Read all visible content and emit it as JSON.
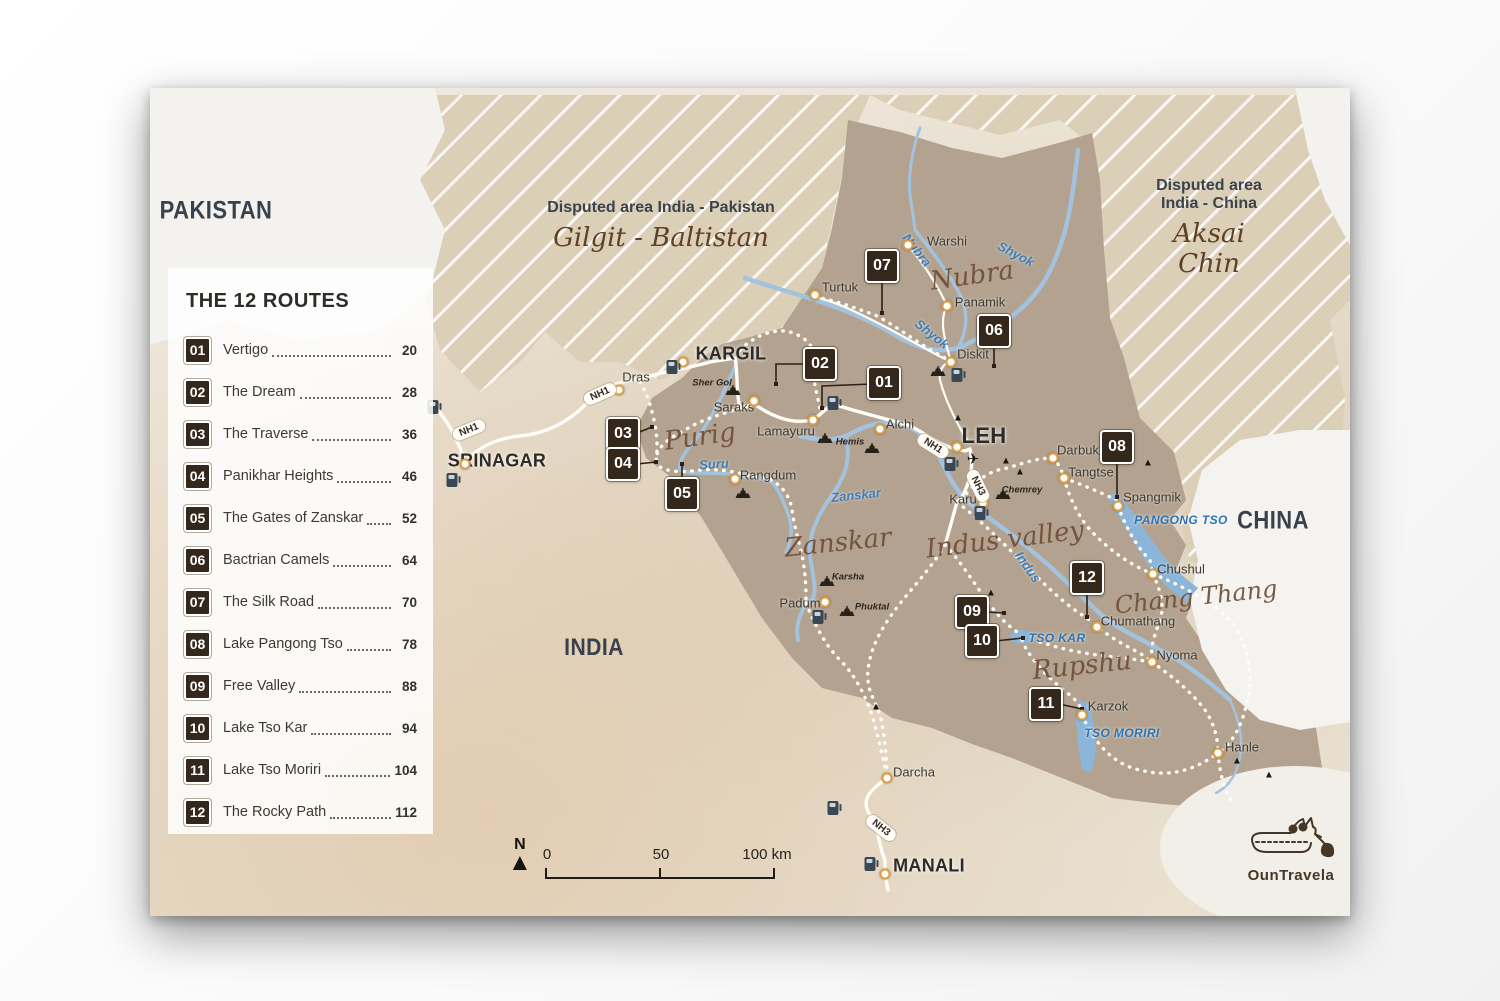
{
  "legend": {
    "title": "THE 12 ROUTES",
    "routes": [
      {
        "num": "01",
        "name": "Vertigo",
        "page": "20"
      },
      {
        "num": "02",
        "name": "The Dream",
        "page": "28"
      },
      {
        "num": "03",
        "name": "The Traverse",
        "page": "36"
      },
      {
        "num": "04",
        "name": "Panikhar Heights",
        "page": "46"
      },
      {
        "num": "05",
        "name": "The Gates of Zanskar",
        "page": "52"
      },
      {
        "num": "06",
        "name": "Bactrian Camels",
        "page": "64"
      },
      {
        "num": "07",
        "name": "The Silk Road",
        "page": "70"
      },
      {
        "num": "08",
        "name": "Lake Pangong Tso",
        "page": "78"
      },
      {
        "num": "09",
        "name": "Free Valley",
        "page": "88"
      },
      {
        "num": "10",
        "name": "Lake Tso Kar",
        "page": "94"
      },
      {
        "num": "11",
        "name": "Lake Tso Moriri",
        "page": "104"
      },
      {
        "num": "12",
        "name": "The Rocky Path",
        "page": "112"
      }
    ]
  },
  "disputed": [
    {
      "title": "Disputed area India - Pakistan",
      "subtitle": "Gilgit - Baltistan"
    },
    {
      "title": "Disputed area India - China",
      "subtitle": "Aksai Chin"
    }
  ],
  "countries": [
    {
      "t": "PAKISTAN",
      "x": 216,
      "y": 211,
      "s": 25
    },
    {
      "t": "INDIA",
      "x": 594,
      "y": 648,
      "s": 24
    },
    {
      "t": "CHINA",
      "x": 1273,
      "y": 521,
      "s": 25
    }
  ],
  "cities": [
    {
      "t": "SRINAGAR",
      "x": 497,
      "y": 461,
      "s": 18,
      "dot": [
        465,
        464
      ]
    },
    {
      "t": "KARGIL",
      "x": 731,
      "y": 354,
      "s": 18,
      "dot": [
        683,
        362
      ]
    },
    {
      "t": "LEH",
      "x": 984,
      "y": 436,
      "s": 22,
      "dot": [
        957,
        447
      ]
    },
    {
      "t": "MANALI",
      "x": 929,
      "y": 866,
      "s": 18,
      "dot": [
        885,
        874
      ]
    }
  ],
  "towns": [
    {
      "t": "Dras",
      "x": 636,
      "y": 377,
      "dot": [
        619,
        390
      ]
    },
    {
      "t": "Saraks",
      "x": 734,
      "y": 407,
      "dot": [
        754,
        401
      ]
    },
    {
      "t": "Lamayuru",
      "x": 786,
      "y": 431,
      "dot": [
        813,
        420
      ]
    },
    {
      "t": "Alchi",
      "x": 900,
      "y": 424,
      "dot": [
        880,
        429
      ]
    },
    {
      "t": "Rangdum",
      "x": 768,
      "y": 475,
      "dot": [
        735,
        479
      ]
    },
    {
      "t": "Padum",
      "x": 800,
      "y": 603,
      "dot": [
        825,
        602
      ]
    },
    {
      "t": "Turtuk",
      "x": 840,
      "y": 287,
      "dot": [
        815,
        295
      ]
    },
    {
      "t": "Warshi",
      "x": 947,
      "y": 241,
      "dot": [
        908,
        245
      ]
    },
    {
      "t": "Panamik",
      "x": 980,
      "y": 302,
      "dot": [
        947,
        306
      ]
    },
    {
      "t": "Diskit",
      "x": 973,
      "y": 354,
      "dot": [
        951,
        362
      ]
    },
    {
      "t": "Darbuk",
      "x": 1078,
      "y": 450,
      "dot": [
        1053,
        458
      ]
    },
    {
      "t": "Tangtse",
      "x": 1091,
      "y": 472,
      "dot": [
        1064,
        478
      ]
    },
    {
      "t": "Spangmik",
      "x": 1152,
      "y": 497,
      "dot": [
        1118,
        506
      ]
    },
    {
      "t": "Chushul",
      "x": 1181,
      "y": 569,
      "dot": [
        1153,
        574
      ]
    },
    {
      "t": "Chumathang",
      "x": 1138,
      "y": 621,
      "dot": [
        1097,
        627
      ]
    },
    {
      "t": "Nyoma",
      "x": 1177,
      "y": 655,
      "dot": [
        1152,
        662
      ]
    },
    {
      "t": "Karzok",
      "x": 1108,
      "y": 706,
      "dot": [
        1082,
        715
      ]
    },
    {
      "t": "Hanle",
      "x": 1242,
      "y": 747,
      "dot": [
        1218,
        753
      ]
    },
    {
      "t": "Darcha",
      "x": 914,
      "y": 772,
      "dot": [
        887,
        778
      ]
    },
    {
      "t": "Karu",
      "x": 963,
      "y": 499,
      "dot": [
        983,
        503
      ]
    }
  ],
  "monasteries": [
    {
      "t": "Sher Gol",
      "x": 712,
      "y": 383,
      "icon": [
        733,
        390
      ]
    },
    {
      "t": "Hemis",
      "x": 850,
      "y": 442,
      "icon": [
        872,
        448
      ]
    },
    {
      "t": "Karsha",
      "x": 848,
      "y": 577,
      "icon": [
        827,
        581
      ]
    },
    {
      "t": "Phuktal",
      "x": 872,
      "y": 607,
      "icon": [
        847,
        611
      ]
    },
    {
      "t": "Chemrey",
      "x": 1022,
      "y": 490,
      "icon": [
        1003,
        494
      ]
    },
    {
      "t": "",
      "x": 0,
      "y": 0,
      "icon": [
        938,
        371
      ]
    },
    {
      "t": "",
      "x": 0,
      "y": 0,
      "icon": [
        825,
        438
      ]
    },
    {
      "t": "",
      "x": 0,
      "y": 0,
      "icon": [
        743,
        493
      ]
    }
  ],
  "rivers": [
    {
      "t": "Nubra",
      "x": 917,
      "y": 250,
      "r": 52
    },
    {
      "t": "Shyok",
      "x": 1016,
      "y": 254,
      "r": 28
    },
    {
      "t": "Shyok",
      "x": 932,
      "y": 334,
      "r": 38
    },
    {
      "t": "Suru",
      "x": 714,
      "y": 464,
      "r": -4
    },
    {
      "t": "Zanskar",
      "x": 856,
      "y": 495,
      "r": -6
    },
    {
      "t": "Indus",
      "x": 1028,
      "y": 567,
      "r": 55
    }
  ],
  "lakes": [
    {
      "t": "PANGONG TSO",
      "x": 1181,
      "y": 520,
      "r": 0
    },
    {
      "t": "TSO KAR",
      "x": 1057,
      "y": 638,
      "r": 0
    },
    {
      "t": "TSO MORIRI",
      "x": 1122,
      "y": 733,
      "r": 0
    }
  ],
  "regions": [
    {
      "t": "Nubra",
      "x": 972,
      "y": 276,
      "s": 26,
      "r": -8
    },
    {
      "t": "Purig",
      "x": 700,
      "y": 437,
      "s": 26,
      "r": -8
    },
    {
      "t": "Zanskar",
      "x": 838,
      "y": 543,
      "s": 26,
      "r": -6
    },
    {
      "t": "Indus valley",
      "x": 1005,
      "y": 540,
      "s": 26,
      "r": -7
    },
    {
      "t": "Chang Thang",
      "x": 1196,
      "y": 597,
      "s": 24,
      "r": -6
    },
    {
      "t": "Rupshu",
      "x": 1082,
      "y": 666,
      "s": 26,
      "r": -6
    }
  ],
  "nh_labels": [
    {
      "t": "NH1",
      "x": 469,
      "y": 430,
      "r": -22
    },
    {
      "t": "NH1",
      "x": 600,
      "y": 394,
      "r": -24
    },
    {
      "t": "NH1",
      "x": 933,
      "y": 446,
      "r": 32
    },
    {
      "t": "NH3",
      "x": 978,
      "y": 486,
      "r": 64
    },
    {
      "t": "NH3",
      "x": 881,
      "y": 828,
      "r": 38
    }
  ],
  "markers": [
    {
      "num": "01",
      "x": 884,
      "y": 383,
      "leader": [
        [
          872,
          384
        ],
        [
          822,
          386
        ],
        [
          822,
          408
        ]
      ]
    },
    {
      "num": "02",
      "x": 820,
      "y": 364,
      "leader": [
        [
          808,
          364
        ],
        [
          776,
          364
        ],
        [
          776,
          384
        ]
      ]
    },
    {
      "num": "03",
      "x": 623,
      "y": 434,
      "leader": [
        [
          637,
          433
        ],
        [
          652,
          427
        ]
      ]
    },
    {
      "num": "04",
      "x": 623,
      "y": 464,
      "leader": [
        [
          637,
          464
        ],
        [
          656,
          462
        ]
      ]
    },
    {
      "num": "05",
      "x": 682,
      "y": 494,
      "leader": [
        [
          682,
          483
        ],
        [
          682,
          464
        ]
      ]
    },
    {
      "num": "06",
      "x": 994,
      "y": 331,
      "leader": [
        [
          994,
          343
        ],
        [
          994,
          366
        ]
      ]
    },
    {
      "num": "07",
      "x": 882,
      "y": 266,
      "leader": [
        [
          882,
          278
        ],
        [
          882,
          313
        ]
      ]
    },
    {
      "num": "08",
      "x": 1117,
      "y": 447,
      "leader": [
        [
          1117,
          459
        ],
        [
          1117,
          497
        ]
      ]
    },
    {
      "num": "09",
      "x": 972,
      "y": 612,
      "leader": [
        [
          985,
          612
        ],
        [
          1004,
          613
        ]
      ]
    },
    {
      "num": "10",
      "x": 982,
      "y": 641,
      "leader": [
        [
          995,
          641
        ],
        [
          1023,
          638
        ]
      ]
    },
    {
      "num": "11",
      "x": 1046,
      "y": 704,
      "leader": [
        [
          1059,
          704
        ],
        [
          1082,
          709
        ]
      ]
    },
    {
      "num": "12",
      "x": 1087,
      "y": 578,
      "leader": [
        [
          1087,
          590
        ],
        [
          1087,
          617
        ]
      ]
    }
  ],
  "mountains": [
    {
      "x": 958,
      "y": 418
    },
    {
      "x": 1006,
      "y": 461
    },
    {
      "x": 1020,
      "y": 472
    },
    {
      "x": 1148,
      "y": 463
    },
    {
      "x": 991,
      "y": 593
    },
    {
      "x": 876,
      "y": 707
    },
    {
      "x": 1237,
      "y": 761
    },
    {
      "x": 1269,
      "y": 775
    }
  ],
  "fuel": [
    {
      "x": 433,
      "y": 407
    },
    {
      "x": 452,
      "y": 480
    },
    {
      "x": 672,
      "y": 367
    },
    {
      "x": 833,
      "y": 403
    },
    {
      "x": 950,
      "y": 464
    },
    {
      "x": 957,
      "y": 375
    },
    {
      "x": 980,
      "y": 513
    },
    {
      "x": 818,
      "y": 617
    },
    {
      "x": 833,
      "y": 808
    },
    {
      "x": 870,
      "y": 864
    }
  ],
  "airport": {
    "x": 973,
    "y": 459
  },
  "scalebar": {
    "north": "N",
    "labels": [
      "0",
      "50",
      "100 km"
    ]
  },
  "logo": {
    "text": "OunTravela"
  }
}
